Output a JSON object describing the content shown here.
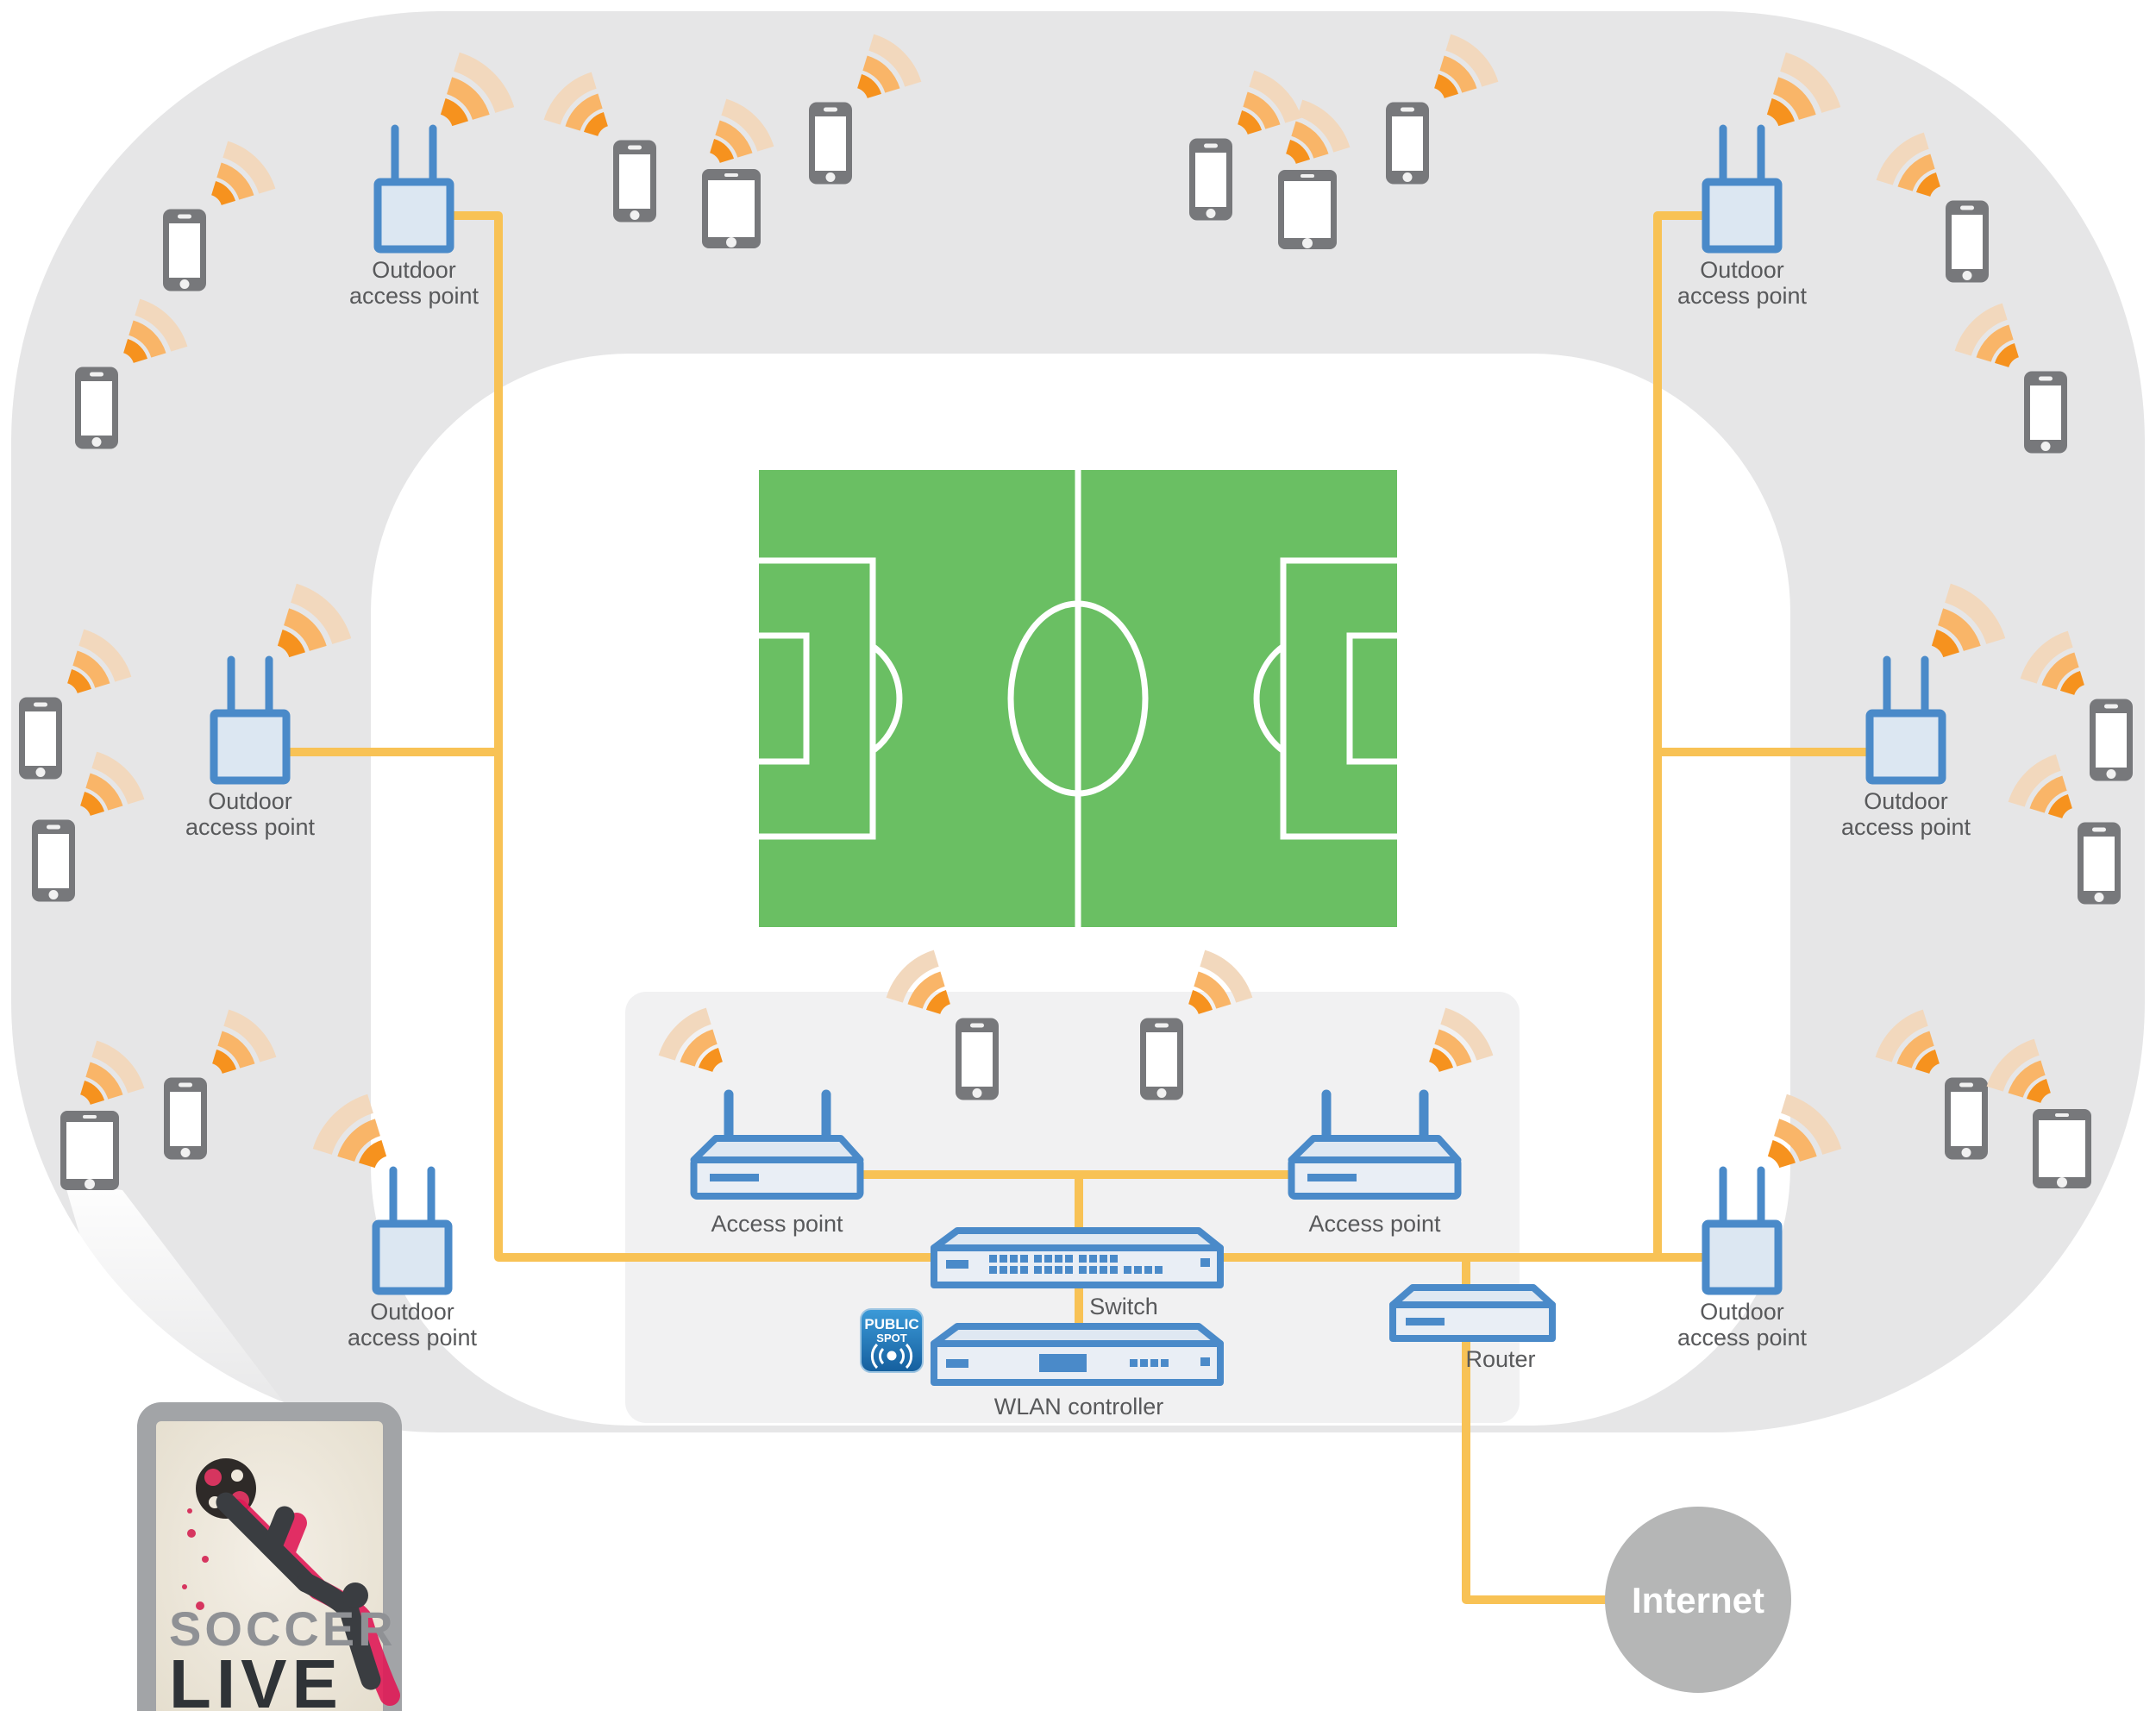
{
  "diagram_title": "Stadium public Wi-Fi network diagram",
  "labels": {
    "outdoor_ap_line1": "Outdoor",
    "outdoor_ap_line2": "access point",
    "access_point": "Access point",
    "switch": "Switch",
    "wlan_controller": "WLAN controller",
    "router": "Router",
    "internet": "Internet"
  },
  "badge": {
    "line1": "PUBLIC",
    "line2": "SPOT"
  },
  "poster": {
    "line1": "SOCCER",
    "line2": "LIVE"
  },
  "counts": {
    "outdoor_access_points": 6,
    "indoor_access_points": 2,
    "phones": 16,
    "tablets": 4
  },
  "colors": {
    "stadium_gray": "#e6e6e7",
    "concourse_white": "#ffffff",
    "panel_gray": "#f1f1f2",
    "field_green": "#6abf63",
    "field_line": "#ffffff",
    "device_gray": "#77787b",
    "ap_blue": "#4a8ac9",
    "ap_fill": "#dce7f2",
    "equipment_fill": "#e9eef5",
    "cable_orange": "#f8c255",
    "wifi_strong": "#f6921e",
    "wifi_mid": "#f9b568",
    "wifi_weak": "#f2d8bd",
    "internet_gray": "#b5b6b6",
    "badge_blue": "#1b6fb4",
    "poster_red": "#e01a57",
    "poster_dark": "#3a3d41",
    "poster_paper": "#eee8dc"
  },
  "icons": [
    "phone-icon",
    "tablet-icon",
    "wifi-signal-icon",
    "antenna-icon",
    "switch-ports-icon",
    "public-spot-wifi-icon",
    "soccer-ball-icon",
    "soccer-player-icon"
  ]
}
